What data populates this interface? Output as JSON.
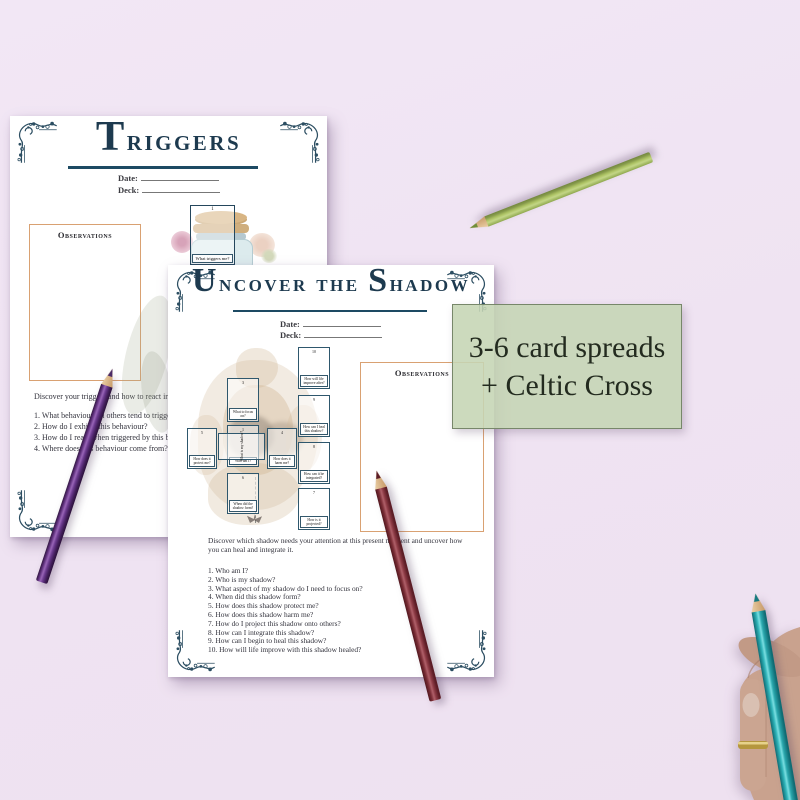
{
  "colors": {
    "background": "#f0e5f3",
    "accent_navy": "#1d3a4f",
    "accent_tan": "#d9a172",
    "badge_green": "#c5d5b4",
    "card_border": "#2e576d"
  },
  "badge": {
    "line1": "3-6 card spreads",
    "line2": "+ Celtic Cross"
  },
  "triggers_page": {
    "title": "Triggers",
    "date_label": "Date:",
    "deck_label": "Deck:",
    "observations_label": "Observations",
    "card": {
      "number": "1",
      "label": "What triggers me?"
    },
    "intro": "Discover your triggers and how to react in the future.",
    "questions": [
      "1. What behaviours in others tend to trigger me?",
      "2. How do I exhibit this behaviour?",
      "3. How do I react when triggered by this behaviour?",
      "4. Where does this behaviour come from?"
    ]
  },
  "shadow_page": {
    "title": "Uncover the Shadow",
    "date_label": "Date:",
    "deck_label": "Deck:",
    "observations_label": "Observations",
    "intro": "Discover which shadow needs your attention at this present moment and uncover how you can heal and integrate it.",
    "questions": [
      "1. Who am I?",
      "2. Who is my shadow?",
      "3. What aspect of my shadow do I need to focus on?",
      "4. When did this shadow form?",
      "5. How does this shadow protect me?",
      "6. How does this shadow harm me?",
      "7. How do I project this shadow onto others?",
      "8. How can I integrate this shadow?",
      "9. How can I begin to heal this shadow?",
      "10. How will life improve with this shadow healed?"
    ],
    "spread": [
      {
        "number": "1",
        "label": "Who am I?"
      },
      {
        "number": "2",
        "label": "What is my shadow?"
      },
      {
        "number": "3",
        "label": "What to focus on?"
      },
      {
        "number": "4",
        "label": "How does it harm me?"
      },
      {
        "number": "5",
        "label": "How does it protect me?"
      },
      {
        "number": "6",
        "label": "When did the shadow form?"
      },
      {
        "number": "7",
        "label": "How is it projected?"
      },
      {
        "number": "8",
        "label": "How can it be integrated?"
      },
      {
        "number": "9",
        "label": "How can I heal this shadow?"
      },
      {
        "number": "10",
        "label": "How will life improve after?"
      }
    ]
  }
}
